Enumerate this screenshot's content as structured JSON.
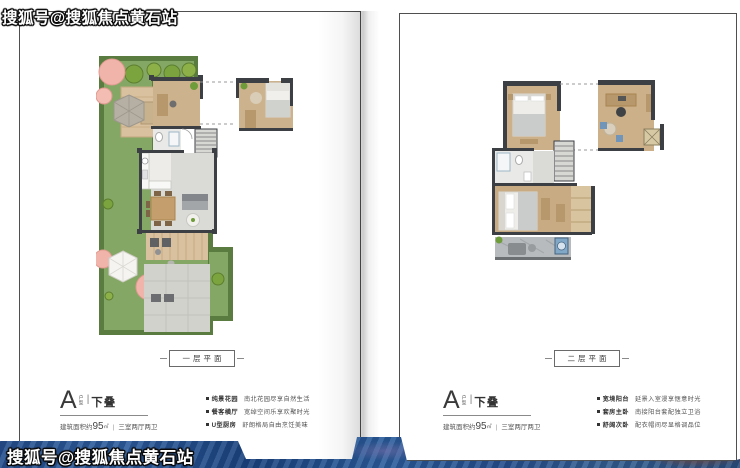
{
  "watermarks": {
    "top": "搜狐号@搜狐焦点黄石站",
    "bottom": "搜狐号@搜狐焦点黄石站"
  },
  "left_page": {
    "plan_label": "一层平面",
    "title": {
      "letter": "A",
      "type": "户型",
      "divider": "|",
      "grade": "下叠"
    },
    "area": {
      "prefix": "建筑面积约",
      "value": "95",
      "unit": "㎡",
      "divider": "|",
      "rooms": "三室两厅两卫"
    },
    "features": [
      {
        "name": "纯景花园",
        "desc": "南北花园尽享自然生活"
      },
      {
        "name": "餐客横厅",
        "desc": "宽绰空间乐享欢聚时光"
      },
      {
        "name": "U型厨房",
        "desc": "舒朗格局自由烹饪美味"
      }
    ]
  },
  "right_page": {
    "plan_label": "二层平面",
    "title": {
      "letter": "A",
      "type": "户型",
      "divider": "|",
      "grade": "下叠"
    },
    "area": {
      "prefix": "建筑面积约",
      "value": "95",
      "unit": "㎡",
      "divider": "|",
      "rooms": "三室两厅两卫"
    },
    "features": [
      {
        "name": "宽境阳台",
        "desc": "延景入室漫享惬意时光"
      },
      {
        "name": "套房主卧",
        "desc": "南接阳台套配独立卫浴"
      },
      {
        "name": "舒阔次卧",
        "desc": "配衣帽间尽显格调品位"
      }
    ]
  },
  "colors": {
    "band_blue": "#24508c",
    "wall": "#3c3f43",
    "lawn": "#84a765",
    "wood_floor": "#ccb08a"
  }
}
